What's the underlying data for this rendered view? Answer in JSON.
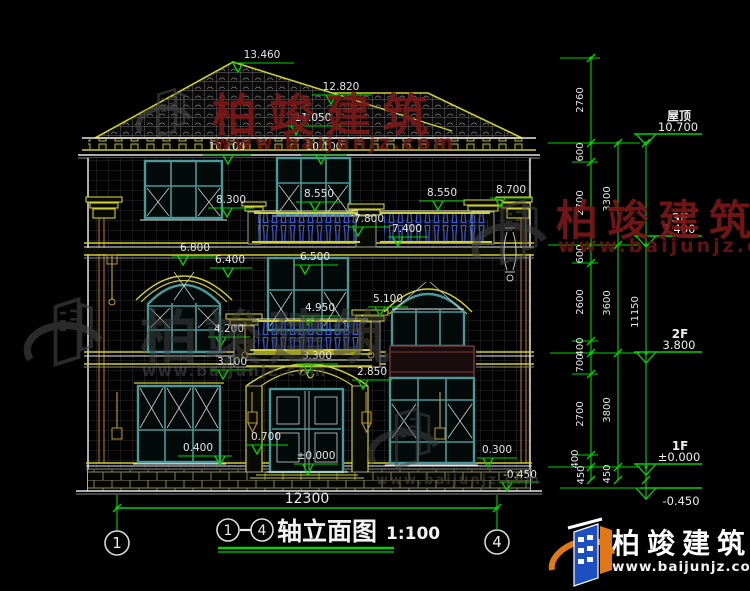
{
  "colors": {
    "dim_green": "#00d400",
    "trim_yellow": "#cfcf30",
    "frame_teal": "#4b9898",
    "baluster_blue": "#3a5ed6",
    "watermark_red": "#7a1717",
    "watermark_gray": "#474747",
    "logo_blue": "#1d4fc0",
    "logo_orange": "#e07818"
  },
  "brand": {
    "name": "柏竣建筑",
    "url": "www.baijunjz.com"
  },
  "title": {
    "axis_start": "1",
    "axis_end": "4",
    "name": "轴立面图",
    "scale": "1:100"
  },
  "axes": {
    "left": "1",
    "right": "4"
  },
  "floors": {
    "roof_name": "屋顶",
    "roof_level": "10.700",
    "f3_name": "3F",
    "f3_level": "7.400",
    "f2_name": "2F",
    "f2_level": "3.800",
    "f1_name": "1F",
    "f1_level": "±0.000",
    "ground_level": "-0.450"
  },
  "levels": {
    "peak": "13.460",
    "ridge": "12.820",
    "cornice": "11.050",
    "win_head_3f": "10.100",
    "sill_left_3f": "8.300",
    "rail_3f": "8.550",
    "cap_right": "8.700",
    "rail_mid": "7.800",
    "deck_3f": "7.400",
    "arch_left_2f": "6.800",
    "spring_left_2f": "6.400",
    "head_mid_2f": "6.500",
    "spring_right_2f": "5.100",
    "rail_2f": "4.950",
    "sill_left_2f": "4.200",
    "slab_2f": "3.300",
    "band_2f": "3.100",
    "arch_door": "2.850",
    "door_mid": "0.700",
    "sill_left_1f": "0.400",
    "sill_right_1f": "0.300",
    "floor_1f": "±0.000",
    "ground": "-0.450"
  },
  "dims": {
    "col1": [
      "2760",
      "600",
      "2700",
      "600",
      "2600",
      "400",
      "700",
      "2700",
      "400",
      "450"
    ],
    "col2": [
      "3300",
      "3600",
      "3800",
      "450"
    ],
    "overall_height": "11150",
    "overall_width": "12300"
  }
}
